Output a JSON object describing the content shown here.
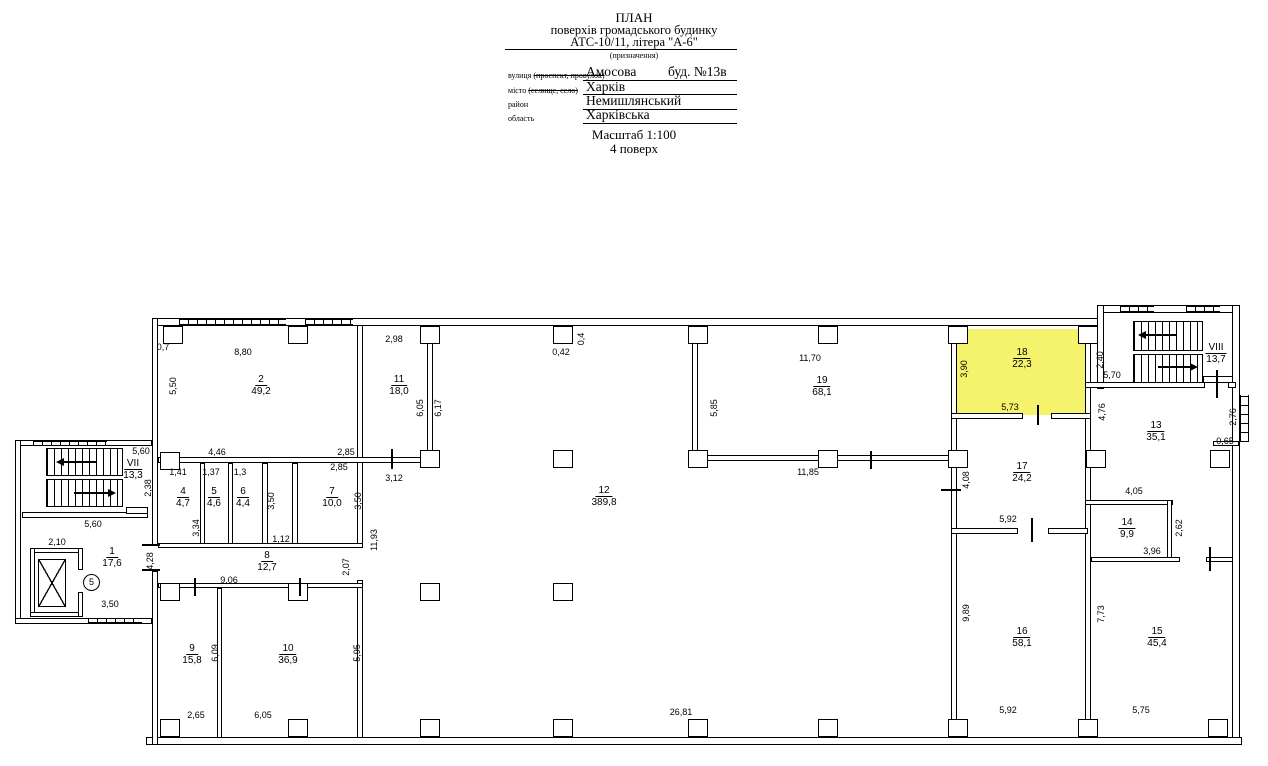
{
  "header": {
    "title_line1": "ПЛАН",
    "title_line2": "поверхів громадського будинку",
    "title_line3": "АТС-10/11, літера \"А-6\"",
    "purpose_note": "(призначення)",
    "fields": [
      {
        "label": "вулиця ",
        "struck": "(проспект, провулок)",
        "value": "Амосова",
        "extra": "буд. №13в"
      },
      {
        "label": "місто ",
        "struck": "(селище, село)",
        "value": "Харків",
        "extra": ""
      },
      {
        "label": "район",
        "struck": "",
        "value": "Немишлянський",
        "extra": ""
      },
      {
        "label": "область",
        "struck": "",
        "value": "Харківська",
        "extra": ""
      }
    ],
    "scale_line": "Масштаб 1:100",
    "floor_line": "4  поверх"
  },
  "plan": {
    "highlight_color": "#F5F36C",
    "highlighted_room": "18",
    "circle_marker": "5",
    "rooms": [
      {
        "num": "1",
        "area": "17,6",
        "x": 112,
        "y": 546
      },
      {
        "num": "2",
        "area": "49,2",
        "x": 261,
        "y": 374
      },
      {
        "num": "4",
        "area": "4,7",
        "x": 183,
        "y": 486
      },
      {
        "num": "5",
        "area": "4,6",
        "x": 214,
        "y": 486
      },
      {
        "num": "6",
        "area": "4,4",
        "x": 243,
        "y": 486
      },
      {
        "num": "7",
        "area": "10,0",
        "x": 332,
        "y": 486
      },
      {
        "num": "8",
        "area": "12,7",
        "x": 267,
        "y": 550
      },
      {
        "num": "9",
        "area": "15,8",
        "x": 192,
        "y": 643
      },
      {
        "num": "10",
        "area": "36,9",
        "x": 288,
        "y": 643
      },
      {
        "num": "11",
        "area": "18,0",
        "x": 399,
        "y": 374
      },
      {
        "num": "12",
        "area": "389,8",
        "x": 604,
        "y": 485
      },
      {
        "num": "13",
        "area": "35,1",
        "x": 1156,
        "y": 420
      },
      {
        "num": "14",
        "area": "9,9",
        "x": 1127,
        "y": 517
      },
      {
        "num": "15",
        "area": "45,4",
        "x": 1157,
        "y": 626
      },
      {
        "num": "16",
        "area": "58,1",
        "x": 1022,
        "y": 626
      },
      {
        "num": "17",
        "area": "24,2",
        "x": 1022,
        "y": 461
      },
      {
        "num": "18",
        "area": "22,3",
        "x": 1022,
        "y": 347
      },
      {
        "num": "19",
        "area": "68,1",
        "x": 822,
        "y": 375
      },
      {
        "num": "VII",
        "area": "13,3",
        "x": 133,
        "y": 458
      },
      {
        "num": "VIII",
        "area": "13,7",
        "x": 1216,
        "y": 342
      }
    ],
    "dims_h": [
      {
        "t": "0,7",
        "x": 163,
        "y": 347
      },
      {
        "t": "8,80",
        "x": 243,
        "y": 352
      },
      {
        "t": "2,98",
        "x": 394,
        "y": 339
      },
      {
        "t": "0,42",
        "x": 561,
        "y": 352
      },
      {
        "t": "11,70",
        "x": 810,
        "y": 358
      },
      {
        "t": "5,73",
        "x": 1010,
        "y": 407
      },
      {
        "t": "5,70",
        "x": 1112,
        "y": 375
      },
      {
        "t": "0,65",
        "x": 1225,
        "y": 441
      },
      {
        "t": "11,85",
        "x": 808,
        "y": 472
      },
      {
        "t": "4,46",
        "x": 217,
        "y": 452
      },
      {
        "t": "2,85",
        "x": 346,
        "y": 452
      },
      {
        "t": "2,85",
        "x": 339,
        "y": 467
      },
      {
        "t": "3,12",
        "x": 394,
        "y": 478
      },
      {
        "t": "1,41",
        "x": 178,
        "y": 472
      },
      {
        "t": "1,37",
        "x": 211,
        "y": 472
      },
      {
        "t": "1,3",
        "x": 240,
        "y": 472
      },
      {
        "t": "1,12",
        "x": 281,
        "y": 539
      },
      {
        "t": "9,06",
        "x": 229,
        "y": 580
      },
      {
        "t": "5,92",
        "x": 1008,
        "y": 519
      },
      {
        "t": "4,05",
        "x": 1134,
        "y": 491
      },
      {
        "t": "3,96",
        "x": 1152,
        "y": 551
      },
      {
        "t": "5,60",
        "x": 141,
        "y": 451
      },
      {
        "t": "5,60",
        "x": 93,
        "y": 524
      },
      {
        "t": "2,10",
        "x": 57,
        "y": 542
      },
      {
        "t": "3,50",
        "x": 110,
        "y": 604
      },
      {
        "t": "2,65",
        "x": 196,
        "y": 715
      },
      {
        "t": "6,05",
        "x": 263,
        "y": 715
      },
      {
        "t": "5,92",
        "x": 1008,
        "y": 710
      },
      {
        "t": "5,75",
        "x": 1141,
        "y": 710
      },
      {
        "t": "26,81",
        "x": 681,
        "y": 712
      }
    ],
    "dims_v": [
      {
        "t": "5,50",
        "x": 173,
        "y": 386
      },
      {
        "t": "6,05",
        "x": 420,
        "y": 408
      },
      {
        "t": "6,17",
        "x": 438,
        "y": 408
      },
      {
        "t": "0,4",
        "x": 581,
        "y": 339
      },
      {
        "t": "5,85",
        "x": 714,
        "y": 408
      },
      {
        "t": "3,90",
        "x": 964,
        "y": 369
      },
      {
        "t": "2,40",
        "x": 1100,
        "y": 360
      },
      {
        "t": "2,76",
        "x": 1233,
        "y": 417
      },
      {
        "t": "4,76",
        "x": 1102,
        "y": 412
      },
      {
        "t": "3,50",
        "x": 271,
        "y": 501
      },
      {
        "t": "3,50",
        "x": 358,
        "y": 501
      },
      {
        "t": "3,34",
        "x": 196,
        "y": 528
      },
      {
        "t": "11,93",
        "x": 374,
        "y": 540
      },
      {
        "t": "2,07",
        "x": 346,
        "y": 567
      },
      {
        "t": "2,38",
        "x": 148,
        "y": 488
      },
      {
        "t": "4,28",
        "x": 150,
        "y": 561
      },
      {
        "t": "4,08",
        "x": 966,
        "y": 480
      },
      {
        "t": "2,62",
        "x": 1179,
        "y": 528
      },
      {
        "t": "6,09",
        "x": 215,
        "y": 653
      },
      {
        "t": "5,95",
        "x": 357,
        "y": 653
      },
      {
        "t": "9,89",
        "x": 966,
        "y": 613
      },
      {
        "t": "7,73",
        "x": 1101,
        "y": 614
      }
    ]
  }
}
